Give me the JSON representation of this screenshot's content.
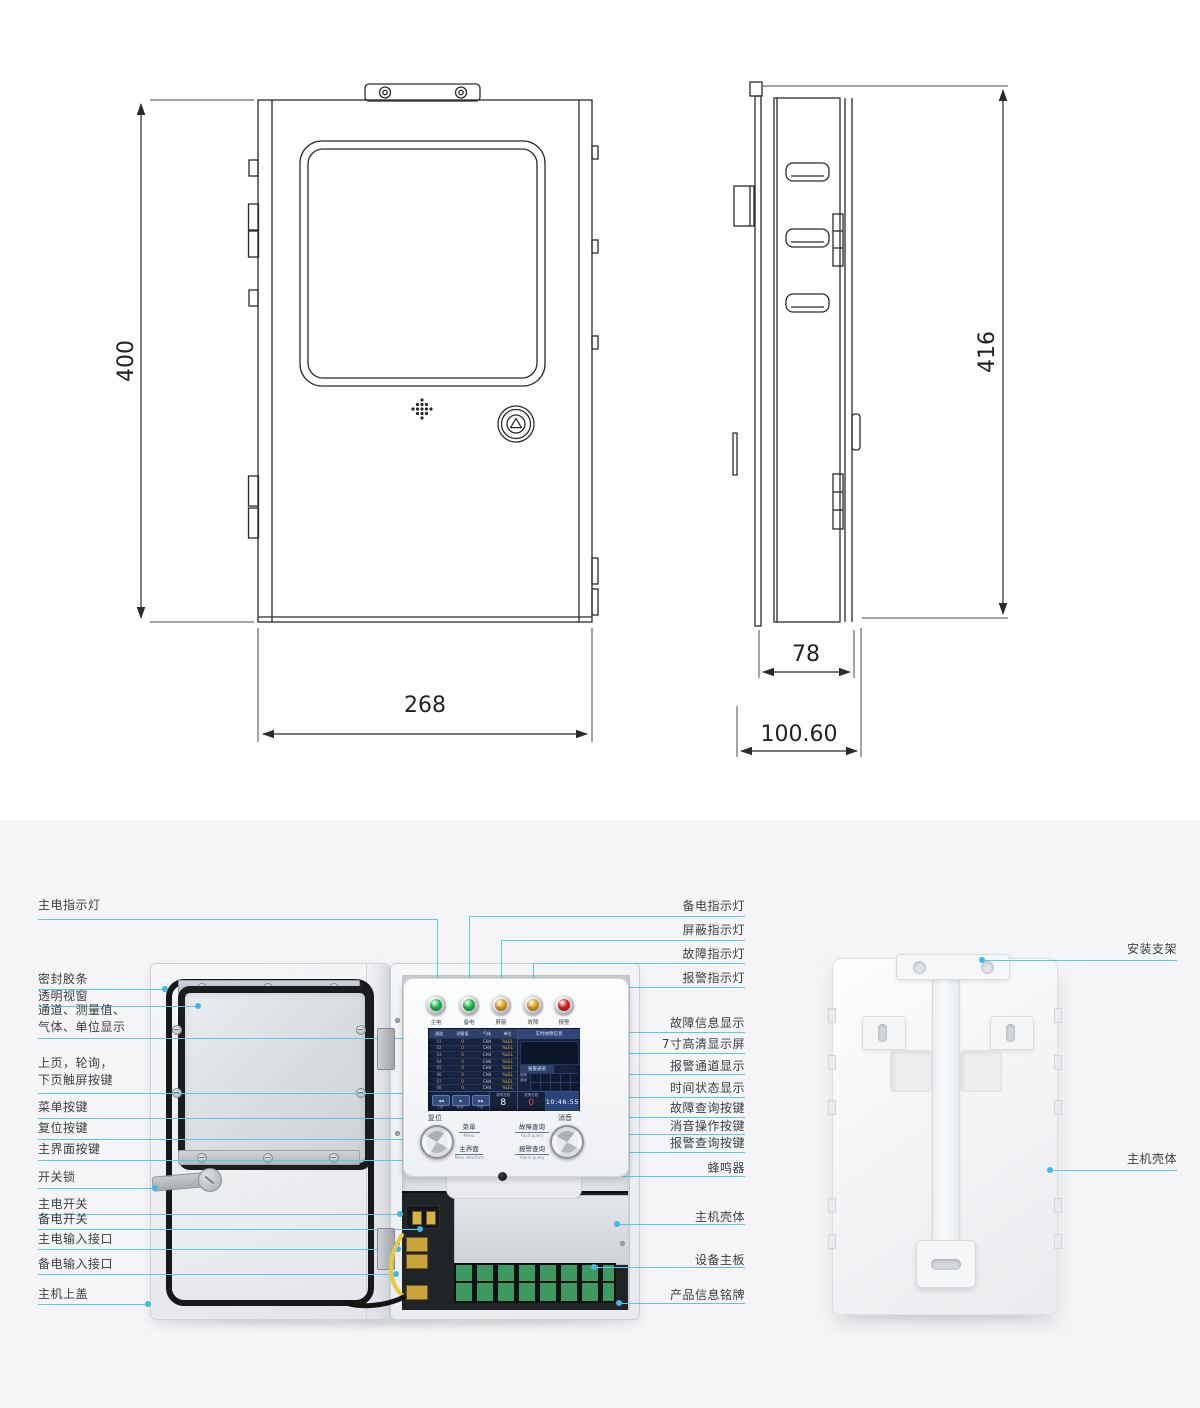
{
  "colors": {
    "leader_line": "#5cc5ec",
    "drawing_stroke": "#2b2b2b",
    "section_background": "#f5f5f7",
    "screen_background": "#17233f",
    "led_green": "#1fbf4c",
    "led_amber": "#e8a11d",
    "led_red": "#e02222"
  },
  "dimensions": {
    "front_height": "400",
    "front_width": "268",
    "side_height": "416",
    "side_depth": "78",
    "side_total_depth": "100.60"
  },
  "device_panel": {
    "leds": [
      {
        "label": "主电",
        "color": "#1fbf4c"
      },
      {
        "label": "备电",
        "color": "#1fbf4c"
      },
      {
        "label": "屏蔽",
        "color": "#e8a11d"
      },
      {
        "label": "故障",
        "color": "#e8a11d"
      },
      {
        "label": "报警",
        "color": "#e02222"
      }
    ],
    "screen": {
      "table_headers": [
        "通道",
        "测量值",
        "气体",
        "单位"
      ],
      "rows": [
        [
          "01",
          "0",
          "CH4",
          "%LEL"
        ],
        [
          "02",
          "0",
          "CH4",
          "%LEL"
        ],
        [
          "03",
          "0",
          "CH4",
          "%LEL"
        ],
        [
          "04",
          "0",
          "CH4",
          "%LEL"
        ],
        [
          "05",
          "0",
          "CH4",
          "%LEL"
        ],
        [
          "06",
          "0",
          "CH4",
          "%LEL"
        ],
        [
          "07",
          "0",
          "CH4",
          "%LEL"
        ],
        [
          "08",
          "0",
          "CH4",
          "%LEL"
        ]
      ],
      "fault_panel_title": "实时故障信息",
      "alarm_panel_title": "报警通道",
      "alarm_legend_line1": "报警",
      "alarm_legend_line2": "通道",
      "pager_labels": [
        "上页",
        "轮询",
        "下页"
      ],
      "pager_icons": [
        "◀◀",
        "▶",
        "▶▶"
      ],
      "fault_total_label": "故障总数",
      "fault_total": "8",
      "alarm_total_label": "报警总数",
      "alarm_total": "0",
      "time": "10:46:55"
    },
    "buttons": {
      "reset": "复位",
      "mute": "消音",
      "menu": "菜单",
      "menu_en": "Menu",
      "main_interface": "主界面",
      "main_interface_en": "Main interface",
      "fault_query": "故障查询",
      "fault_query_en": "Fault query",
      "alarm_query": "报警查询",
      "alarm_query_en": "Alarm query"
    }
  },
  "callouts": {
    "left": [
      {
        "text": "主电指示灯"
      },
      {
        "text": "密封胶条"
      },
      {
        "text": "透明视窗"
      },
      {
        "text": "通道、测量值、",
        "text2": "气体、单位显示"
      },
      {
        "text": "上页，轮询，",
        "text2": "下页触屏按键"
      },
      {
        "text": "菜单按键"
      },
      {
        "text": "复位按键"
      },
      {
        "text": "主界面按键"
      },
      {
        "text": "开关锁"
      },
      {
        "text": "主电开关"
      },
      {
        "text": "备电开关"
      },
      {
        "text": "主电输入接口"
      },
      {
        "text": "备电输入接口"
      },
      {
        "text": "主机上盖"
      }
    ],
    "right": [
      {
        "text": "备电指示灯"
      },
      {
        "text": "屏蔽指示灯"
      },
      {
        "text": "故障指示灯"
      },
      {
        "text": "报警指示灯"
      },
      {
        "text": "故障信息显示"
      },
      {
        "text": "7寸高清显示屏"
      },
      {
        "text": "报警通道显示"
      },
      {
        "text": "时间状态显示"
      },
      {
        "text": "故障查询按键"
      },
      {
        "text": "消音操作按键"
      },
      {
        "text": "报警查询按键"
      },
      {
        "text": "蜂鸣器"
      },
      {
        "text": "主机壳体"
      },
      {
        "text": "设备主板"
      },
      {
        "text": "产品信息铭牌"
      }
    ],
    "far_right": [
      {
        "text": "安装支架"
      },
      {
        "text": "主机壳体"
      }
    ]
  }
}
